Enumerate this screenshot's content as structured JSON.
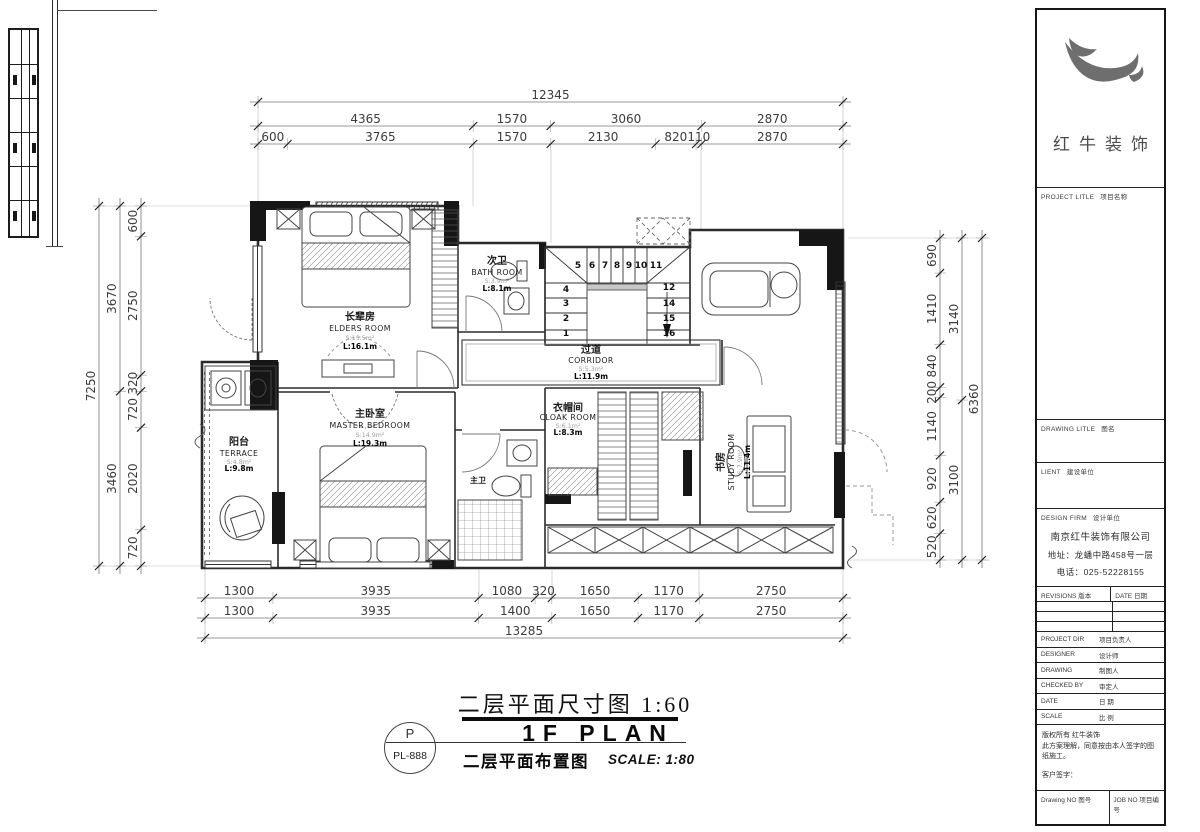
{
  "titles": {
    "dim_plan_title": "二层平面尺寸图 1:60",
    "plan_name_en": "1F PLAN",
    "layout_plan_title": "二层平面布置图",
    "scale_text": "SCALE: 1:80",
    "plan_code_letter": "P",
    "plan_code": "PL-888"
  },
  "dims": {
    "top_total": [
      "12345"
    ],
    "top_row2": [
      "4365",
      "1570",
      "3060",
      "2870"
    ],
    "top_row3": [
      "600",
      "3765",
      "1570",
      "2130",
      "820",
      "110",
      "2870"
    ],
    "bottom_row1": [
      "1300",
      "3935",
      "1080",
      "320",
      "1650",
      "1170",
      "2750"
    ],
    "bottom_row2": [
      "1300",
      "3935",
      "1400",
      "1650",
      "1170",
      "2750"
    ],
    "bottom_total": [
      "13285"
    ],
    "left_total": [
      "7250"
    ],
    "left_mid": [
      "3670",
      "3460"
    ],
    "left_inner": [
      "600",
      "2750",
      "320",
      "720",
      "2020",
      "720"
    ],
    "right_inner": [
      "690",
      "1410",
      "840",
      "200",
      "1140",
      "920",
      "620",
      "520"
    ],
    "right_mid": [
      "3140",
      "3100"
    ],
    "right_total": [
      "6360"
    ]
  },
  "stairs": {
    "left": [
      "4",
      "3",
      "2",
      "1"
    ],
    "top": [
      "5",
      "6",
      "7",
      "8",
      "9",
      "10",
      "11"
    ],
    "right": [
      "12",
      "14",
      "15",
      "16"
    ]
  },
  "rooms": {
    "elders": {
      "cn": "长辈房",
      "en": "ELDERS ROOM",
      "area": "S:15.5m²",
      "length": "L:16.1m"
    },
    "bath": {
      "cn": "次卫",
      "en": "BATH ROOM",
      "area": "S:3.9m²",
      "length": "L:8.1m"
    },
    "corridor": {
      "cn": "过道",
      "en": "CORRIDOR",
      "area": "S:5.3m²",
      "length": "L:11.9m"
    },
    "master": {
      "cn": "主卧室",
      "en": "MASTER BEDROOM",
      "area": "S:14.9m²",
      "length": "L:19.3m"
    },
    "cloak": {
      "cn": "衣帽间",
      "en": "CLOAK ROOM",
      "area": "S:6.1m²",
      "length": "L:8.3m"
    },
    "study": {
      "cn": "书房",
      "en": "STUDY ROOM",
      "area": "S:7.9m²",
      "length": "L:11.4m"
    },
    "terrace": {
      "cn": "阳台",
      "en": "TERRACE",
      "area": "S:4.8m²",
      "length": "L:9.8m"
    },
    "master_bath": {
      "cn": "主卫"
    }
  },
  "title_block": {
    "logo_text": "红牛装饰",
    "project_label_en": "PROJECT LITLE",
    "project_label_cn": "项目名称",
    "drawing_label_en": "DRAWING LITLE",
    "drawing_label_cn": "图名",
    "client_label_en": "LIENT",
    "client_label_cn": "建设单位",
    "firm_label_en": "DESIGN FIRM",
    "firm_label_cn": "设计单位",
    "firm_name": "南京红牛装饰有限公司",
    "firm_address": "地址：龙蟠中路458号一层",
    "firm_phone": "电话：025-52228155",
    "revisions_label": "REVISIONS 版本",
    "date_label": "DATE 日期",
    "fields": [
      {
        "en": "PROJECT DIR",
        "cn": "项目负责人"
      },
      {
        "en": "DESIGNER",
        "cn": "设计师"
      },
      {
        "en": "DRAWING",
        "cn": "制图人"
      },
      {
        "en": "CHECKED BY",
        "cn": "审定人"
      },
      {
        "en": "DATE",
        "cn": "日 期"
      },
      {
        "en": "SCALE",
        "cn": "比 例"
      }
    ],
    "copyright_lines": [
      "版权所有 红牛装饰",
      "此方案理解，同意按由本人签字的图纸施工。",
      "客户签字："
    ],
    "drawing_no_label": "Drawing NO 图号",
    "job_no_label": "JOB NO 项目编号"
  }
}
